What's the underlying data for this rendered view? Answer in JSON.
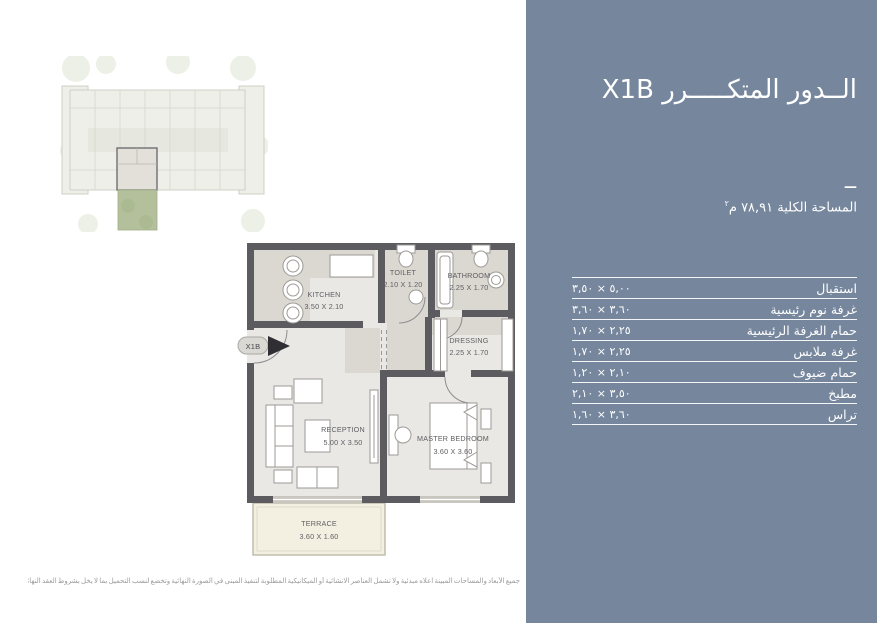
{
  "panel": {
    "bg_color": "#75869D",
    "title": "الــدور المتكـــــرر X1B",
    "divider": "—",
    "total_area": "المساحة الكلية ٧٨,٩١ م",
    "total_area_sup": "٢",
    "rooms": [
      {
        "label": "استقبال",
        "dims": "٥,٠٠ × ٣,٥٠"
      },
      {
        "label": "غرفة نوم رئيسية",
        "dims": "٣,٦٠ × ٣,٦٠"
      },
      {
        "label": "حمام الغرفة الرئيسية",
        "dims": "٢,٢٥ × ١,٧٠"
      },
      {
        "label": "غرفة ملابس",
        "dims": "٢,٢٥ × ١,٧٠"
      },
      {
        "label": "حمام ضيوف",
        "dims": "٢,١٠ × ١,٢٠"
      },
      {
        "label": "مطبخ",
        "dims": "٣,٥٠ × ٢,١٠"
      },
      {
        "label": "تراس",
        "dims": "٣,٦٠ × ١,٦٠"
      }
    ]
  },
  "floorplan": {
    "unit_marker": "X1B",
    "rooms": {
      "kitchen": {
        "name": "KITCHEN",
        "dims": "3.50 X 2.10"
      },
      "toilet": {
        "name": "TOILET",
        "dims": "2.10 X 1.20"
      },
      "bathroom": {
        "name": "BATHROOM",
        "dims": "2.25 X 1.70"
      },
      "dressing": {
        "name": "DRESSING",
        "dims": "2.25 X 1.70"
      },
      "reception": {
        "name": "RECEPTION",
        "dims": "5.00 X 3.50"
      },
      "master_bedroom": {
        "name": "MASTER BEDROOM",
        "dims": "3.60 X 3.60"
      },
      "terrace": {
        "name": "TERRACE",
        "dims": "3.60 X 1.60"
      }
    }
  },
  "disclaimer": "جميع الأبعاد والمساحات المبينة اعلاه مبدئية ولا تشمل العناصر الانشائية أو الميكانيكية المطلوبة لتنفيذ المبنى في الصورة النهائية وتخضع لنسب التحميل بما لا يخل بشروط العقد النهائي للوحدة"
}
